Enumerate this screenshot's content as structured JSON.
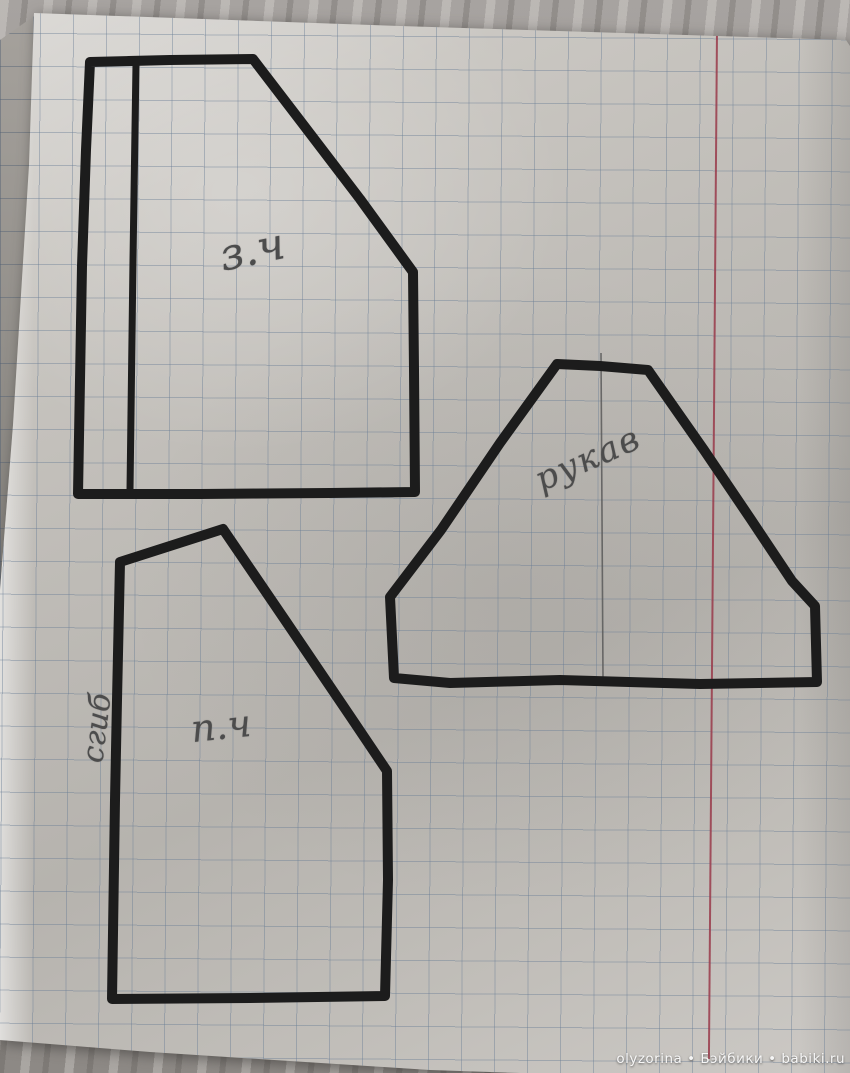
{
  "page": {
    "pieces": {
      "back": {
        "label": "з.ч"
      },
      "sleeve": {
        "label": "рукав"
      },
      "front": {
        "label": "п.ч"
      },
      "fold": {
        "label": "сгиб"
      }
    }
  },
  "watermark": {
    "text": "olyzorina • Бэйбики • babiki.ru"
  },
  "colors": {
    "marker": "#1c1c1c",
    "pencil": "#4c4c4c",
    "grid": "#8fa0b2",
    "margin": "#99394a",
    "paper": "#c1beb9",
    "wood": "#9e9a96"
  }
}
